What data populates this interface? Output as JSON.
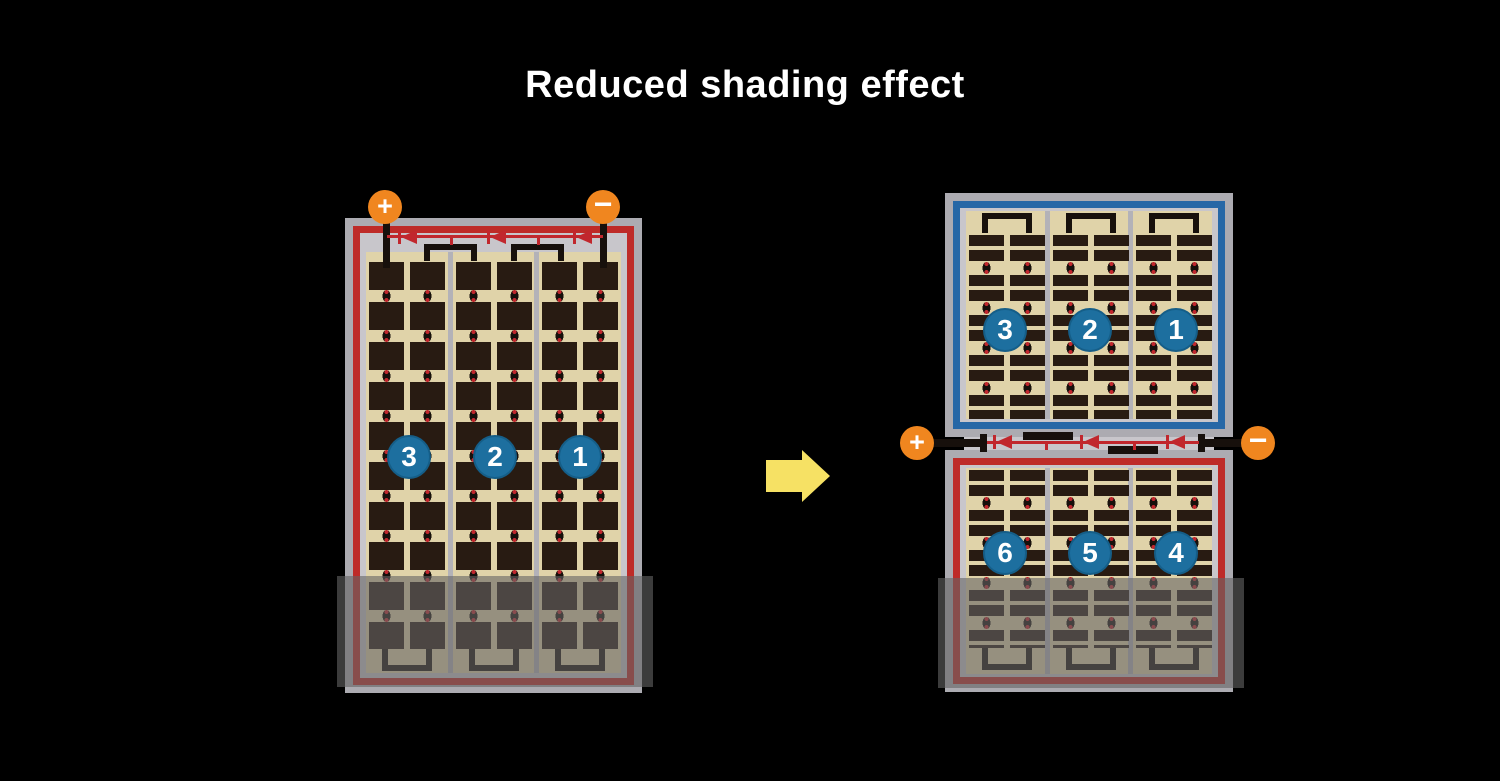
{
  "title": "Reduced shading effect",
  "left_module": {
    "positive_terminal": "+",
    "negative_terminal": "−",
    "string_numbers": [
      "3",
      "2",
      "1"
    ]
  },
  "right_module": {
    "positive_terminal": "+",
    "negative_terminal": "−",
    "top_string_numbers": [
      "3",
      "2",
      "1"
    ],
    "bottom_string_numbers": [
      "6",
      "5",
      "4"
    ]
  },
  "colors": {
    "background": "#000000",
    "title_text": "#ffffff",
    "frame_gray": "#acabb1",
    "inner_gray": "#c8c6cb",
    "cell_tan": "#e0d3a9",
    "cell_dark": "#281b12",
    "wire_black": "#17100c",
    "accent_red": "#c1272d",
    "accent_blue": "#2667a6",
    "badge_blue": "#1d6f9f",
    "terminal_orange": "#f0861f",
    "arrow_yellow": "#f6e164",
    "shade_overlay": "rgba(100,100,100,0.6)"
  }
}
